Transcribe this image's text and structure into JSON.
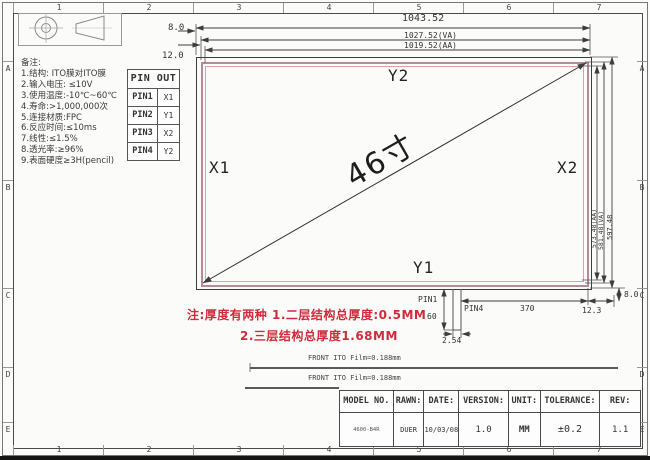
{
  "sheet": {
    "grid_cols": [
      "1",
      "2",
      "3",
      "4",
      "5",
      "6",
      "7"
    ],
    "grid_rows": [
      "A",
      "B",
      "C",
      "D",
      "E"
    ]
  },
  "notes": {
    "title": "备注:",
    "items": [
      "1.结构: ITO膜对ITO膜",
      "2.输入电压: ≤10V",
      "3.使用温度:-10℃~60℃",
      "4.寿命:>1,000,000次",
      "5.连接材质:FPC",
      "6.反应时间:≤10ms",
      "7.线性:≤1.5%",
      "8.透光率:≥96%",
      "9.表面硬度≥3H(pencil)"
    ]
  },
  "pinout": {
    "header": "PIN OUT",
    "rows": [
      {
        "pin": "PIN1",
        "signal": "X1"
      },
      {
        "pin": "PIN2",
        "signal": "Y1"
      },
      {
        "pin": "PIN3",
        "signal": "X2"
      },
      {
        "pin": "PIN4",
        "signal": "Y2"
      }
    ]
  },
  "drawing": {
    "electrodes": {
      "top": "Y2",
      "bottom": "Y1",
      "left": "X1",
      "right": "X2"
    },
    "diagonal_size": "46寸",
    "dims": {
      "overall_width": "1043.52",
      "va_width": "1027.52(VA)",
      "aa_width": "1019.52(AA)",
      "top_gap": "8.0",
      "top_gap2": "12.0",
      "overall_height": "597.48",
      "va_height": "581.48(VA)",
      "aa_height": "573.48(AA)",
      "corner_gap": "8.0",
      "tail_offset": "12.3",
      "tail_length": "370",
      "tail_height": "60",
      "pin_pitch": "2.54",
      "tail_pin1": "PIN1",
      "tail_pin4": "PIN4"
    }
  },
  "red_note": {
    "line1": "注:厚度有两种 1.二层结构总厚度:0.5MM",
    "line2": "2.三层结构总厚度1.68MM"
  },
  "film": {
    "front1": "FRONT ITO Film=0.188mm",
    "front2": "FRONT ITO Film=0.188mm"
  },
  "titleblock": {
    "cells": [
      {
        "header": "MODEL NO.",
        "value": "4600-B4R"
      },
      {
        "header": "RAWN:",
        "value": "DUER"
      },
      {
        "header": "DATE:",
        "value": "10/03/08"
      },
      {
        "header": "VERSION:",
        "value": "1.0"
      },
      {
        "header": "UNIT:",
        "value": "MM"
      },
      {
        "header": "TOLERANCE:",
        "value": "±0.2"
      },
      {
        "header": "REV:",
        "value": "1.1"
      }
    ]
  },
  "colors": {
    "frame_line": "#4a4a4a",
    "va_line": "#b48c96",
    "aa_line": "#d6a6a6",
    "accent_red": "#cf2b3a"
  }
}
